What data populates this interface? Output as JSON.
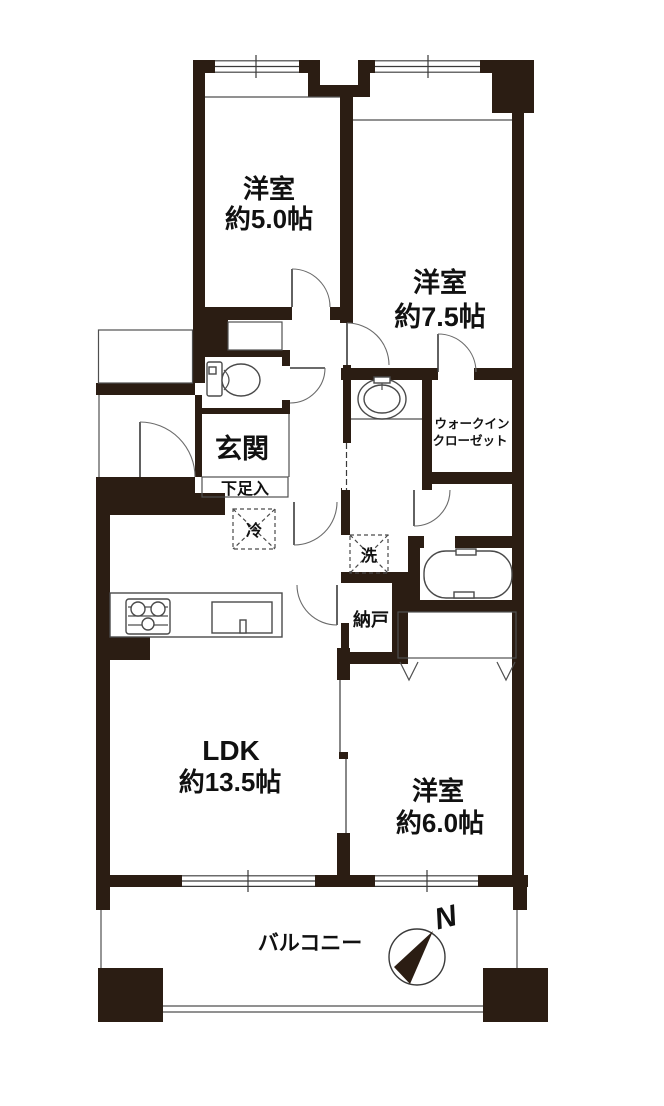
{
  "labels": {
    "bedroom5": {
      "name": "洋室",
      "size": "約5.0帖"
    },
    "bedroom75": {
      "name": "洋室",
      "size": "約7.5帖"
    },
    "bedroom6": {
      "name": "洋室",
      "size": "約6.0帖"
    },
    "ldk": {
      "name": "LDK",
      "size": "約13.5帖"
    },
    "entrance": "玄関",
    "shoe_cabinet": "下足入",
    "wic_line1": "ウォークイン",
    "wic_line2": "クローゼット",
    "storage": "納戸",
    "fridge": "冷",
    "washer": "洗",
    "balcony": "バルコニー",
    "compass_north": "N"
  },
  "colors": {
    "wall": "#2b1d13",
    "line": "#4f4f4f",
    "background": "#ffffff",
    "text": "#111111"
  }
}
